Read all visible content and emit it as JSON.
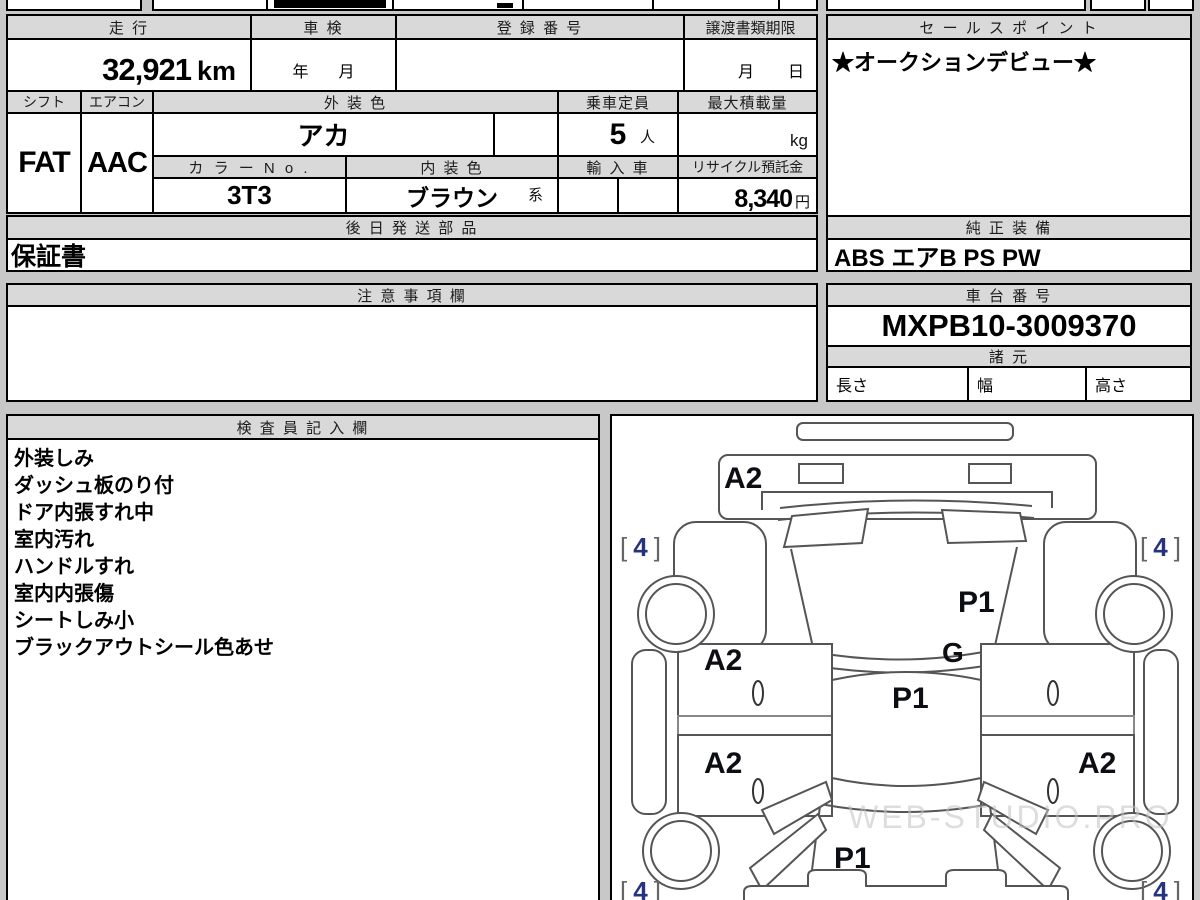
{
  "sheet": {
    "mileage_label": "走 行",
    "mileage_value": "32,921",
    "mileage_unit": "km",
    "inspection_label": "車 検",
    "inspection_year": "年",
    "inspection_month": "月",
    "registration_label": "登 録 番 号",
    "deadline_label": "譲渡書類期限",
    "deadline_month": "月",
    "deadline_day": "日",
    "sales_point_label": "セ ー ル ス ポ イ ン ト",
    "sales_point_value": "★オークションデビュー★",
    "shift_label": "シフト",
    "shift_value": "FAT",
    "aircon_label": "エアコン",
    "aircon_value": "AAC",
    "exterior_label": "外 装 色",
    "exterior_value": "アカ",
    "capacity_label": "乗車定員",
    "capacity_value": "5",
    "capacity_unit": "人",
    "max_load_label": "最大積載量",
    "max_load_unit": "kg",
    "color_no_label": "カ ラ ー N o .",
    "color_no_value": "3T3",
    "interior_label": "内 装 色",
    "interior_value": "ブラウン",
    "interior_suffix": "系",
    "import_label": "輸 入 車",
    "recycle_label": "リサイクル預託金",
    "recycle_value": "8,340",
    "recycle_unit": "円",
    "later_parts_label": "後 日 発 送 部 品",
    "later_parts_value": "保証書",
    "genuine_label": "純 正 装 備",
    "genuine_value": "ABS エアB PS PW",
    "notes_label": "注 意 事 項 欄",
    "chassis_label": "車 台 番 号",
    "chassis_value": "MXPB10-3009370",
    "specs_label": "諸 元",
    "length_label": "長さ",
    "width_label": "幅",
    "height_label": "高さ"
  },
  "inspector": {
    "title": "検 査 員 記 入 欄",
    "notes": [
      "外装しみ",
      "ダッシュ板のり付",
      "ドア内張すれ中",
      "室内汚れ",
      "ハンドルすれ",
      "室内内張傷",
      "シートしみ小",
      "ブラックアウトシール色あせ"
    ]
  },
  "diagram": {
    "marks": {
      "front_panel": "A2",
      "hood": "P1",
      "cowl": "G",
      "roof": "P1",
      "door_front_left": "A2",
      "door_rear_left": "A2",
      "door_rear_right": "A2",
      "trunk": "P1"
    },
    "tire": {
      "open": "[",
      "value": "4",
      "close": "]"
    },
    "watermark": "WEB-STUDIO.PRO",
    "colors": {
      "line": "#555555",
      "mark": "#0d0d14",
      "tire_value": "#26337f"
    }
  },
  "colors": {
    "header_bg": "#d9d9d9",
    "page_bg": "#c8c8c8",
    "border": "#000000"
  }
}
